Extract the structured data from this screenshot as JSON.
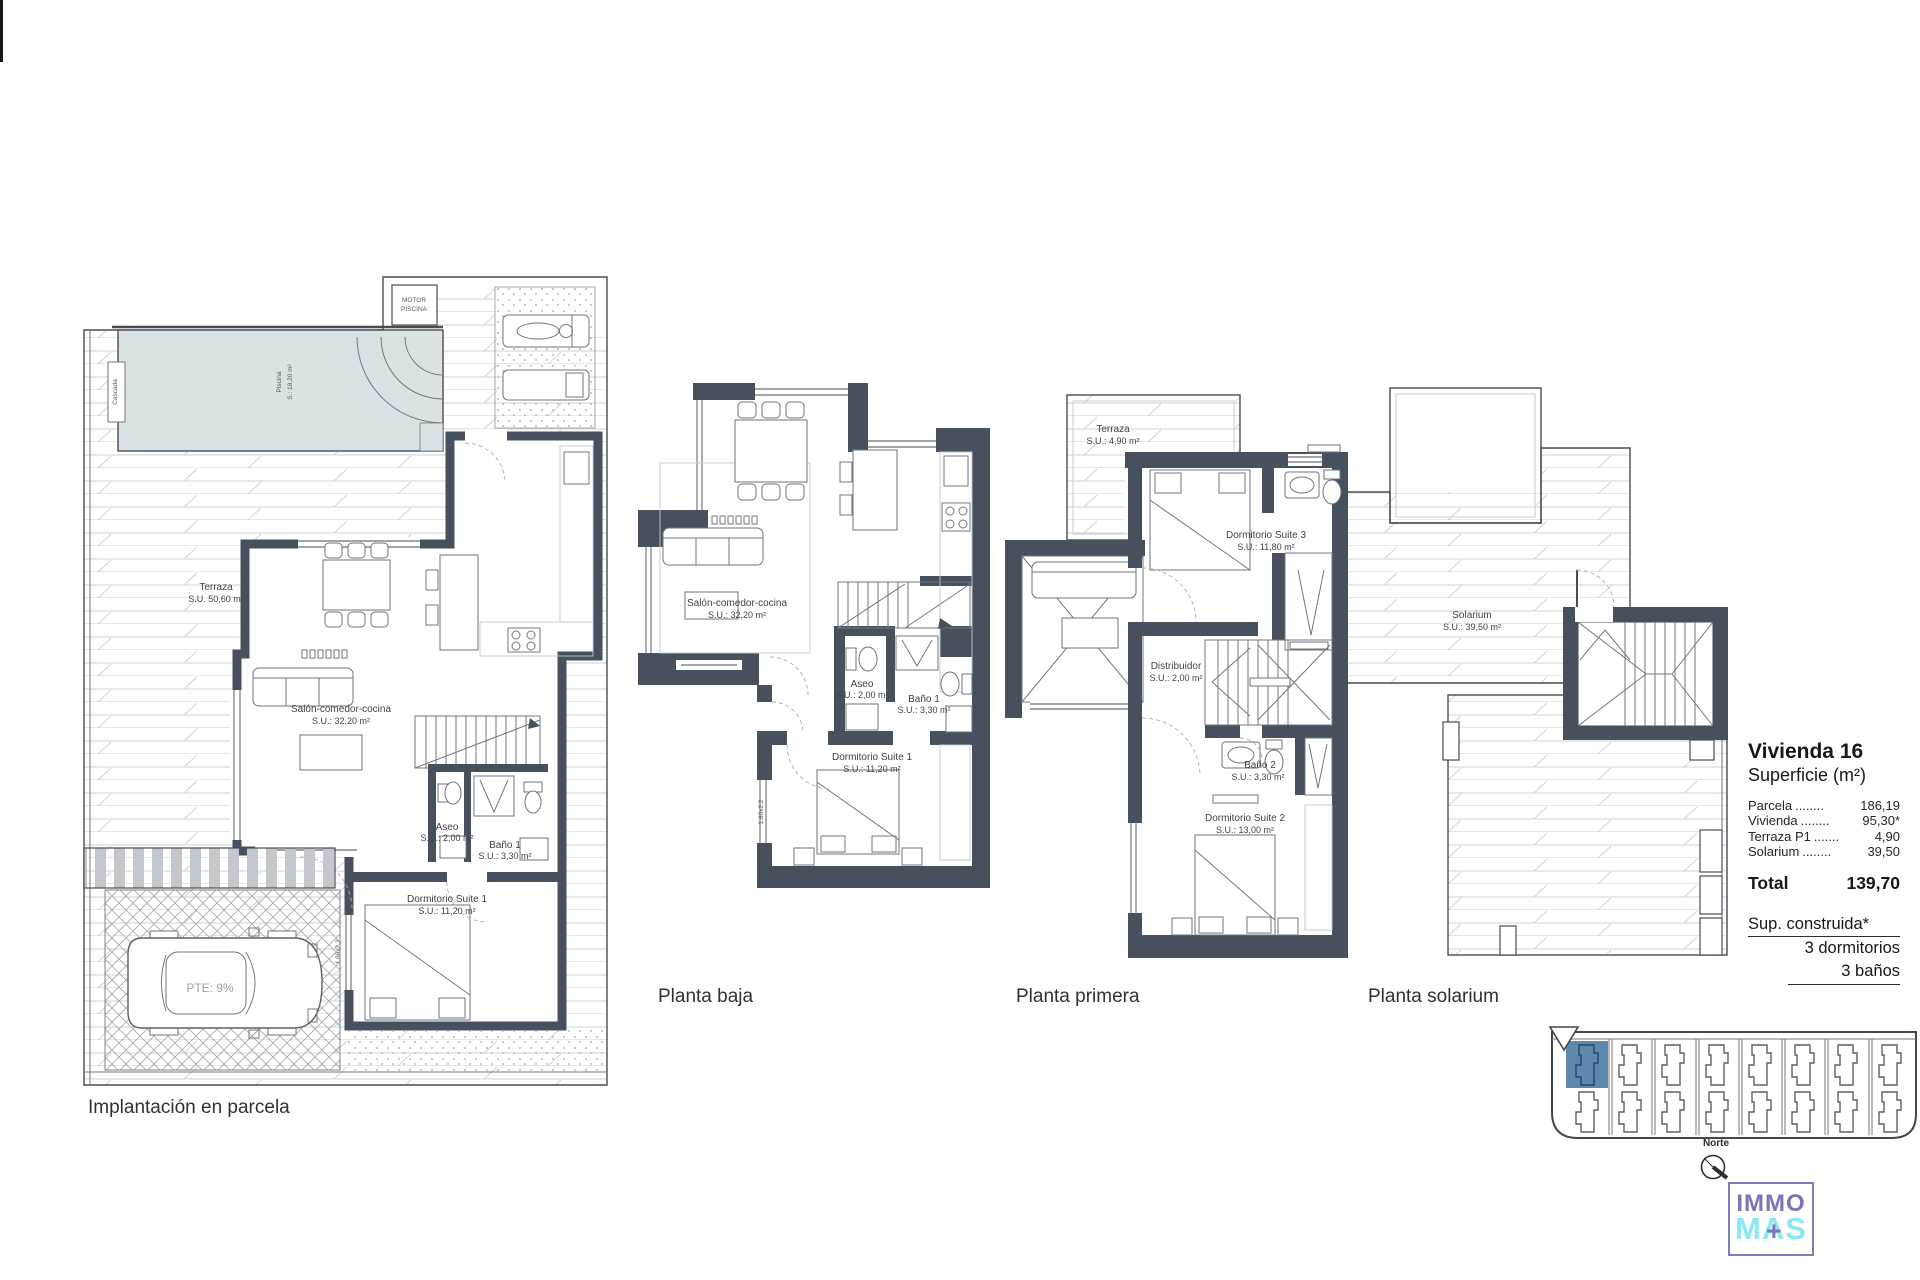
{
  "plans": {
    "parcela": {
      "caption": "Implantación en parcela",
      "motor": {
        "line1": "MOTOR",
        "line2": "PISCINA"
      },
      "cascada": "Cascada",
      "piscina": {
        "name": "Piscina",
        "area": "S.: 18,20 m²"
      },
      "terraza": {
        "name": "Terraza",
        "area": "S.U. 50,60 m²"
      },
      "salon": {
        "name": "Salón-comedor-cocina",
        "area": "S.U.: 32,20 m²"
      },
      "aseo": {
        "name": "Aseo",
        "area": "S.U.: 2,00 m²"
      },
      "bano1": {
        "name": "Baño 1",
        "area": "S.U.: 3,30 m²"
      },
      "dorm1": {
        "name": "Dormitorio Suite 1",
        "area": "S.U.: 11,20 m²"
      },
      "pte": "PTE: 9%",
      "window_dim": "1.80x2.2"
    },
    "baja": {
      "caption": "Planta baja",
      "salon": {
        "name": "Salón-comedor-cocina",
        "area": "S.U.: 32,20 m²"
      },
      "aseo": {
        "name": "Aseo",
        "area": "S.U.: 2,00 m²"
      },
      "bano1": {
        "name": "Baño 1",
        "area": "S.U.: 3,30 m²"
      },
      "dorm1": {
        "name": "Dormitorio Suite 1",
        "area": "S.U.: 11,20 m²"
      },
      "window_dim": "1.80x2.2"
    },
    "primera": {
      "caption": "Planta primera",
      "terraza": {
        "name": "Terraza",
        "area": "S.U.: 4,90 m²"
      },
      "dorm3": {
        "name": "Dormitorio Suite 3",
        "area": "S.U.: 11,80 m²"
      },
      "distribuidor": {
        "name": "Distribuidor",
        "area": "S.U.: 2,00 m²"
      },
      "bano2": {
        "name": "Baño 2",
        "area": "S.U.: 3,30 m²"
      },
      "dorm2": {
        "name": "Dormitorio Suite 2",
        "area": "S.U.: 13,00 m²"
      }
    },
    "solarium": {
      "caption": "Planta solarium",
      "solarium": {
        "name": "Solarium",
        "area": "S.U.: 39,50 m²"
      }
    }
  },
  "info_panel": {
    "title": "Vivienda 16",
    "subtitle": "Superficie (m²)",
    "rows": [
      {
        "name": "Parcela",
        "dots": "........",
        "value": "186,19"
      },
      {
        "name": "Vivienda",
        "dots": "........",
        "value": "95,30*"
      },
      {
        "name": "Terraza P1",
        "dots": ".......",
        "value": "4,90"
      },
      {
        "name": "Solarium",
        "dots": "........",
        "value": "39,50"
      }
    ],
    "total": {
      "label": "Total",
      "value": "139,70"
    },
    "note": "Sup. construida*",
    "bedrooms": "3 dormitorios",
    "bathrooms": "3 baños"
  },
  "site_plan": {
    "units": 8
  },
  "compass": {
    "label": "Norte"
  },
  "logo": {
    "top": "IMMO",
    "bottom": "MAS",
    "plus": "+"
  }
}
